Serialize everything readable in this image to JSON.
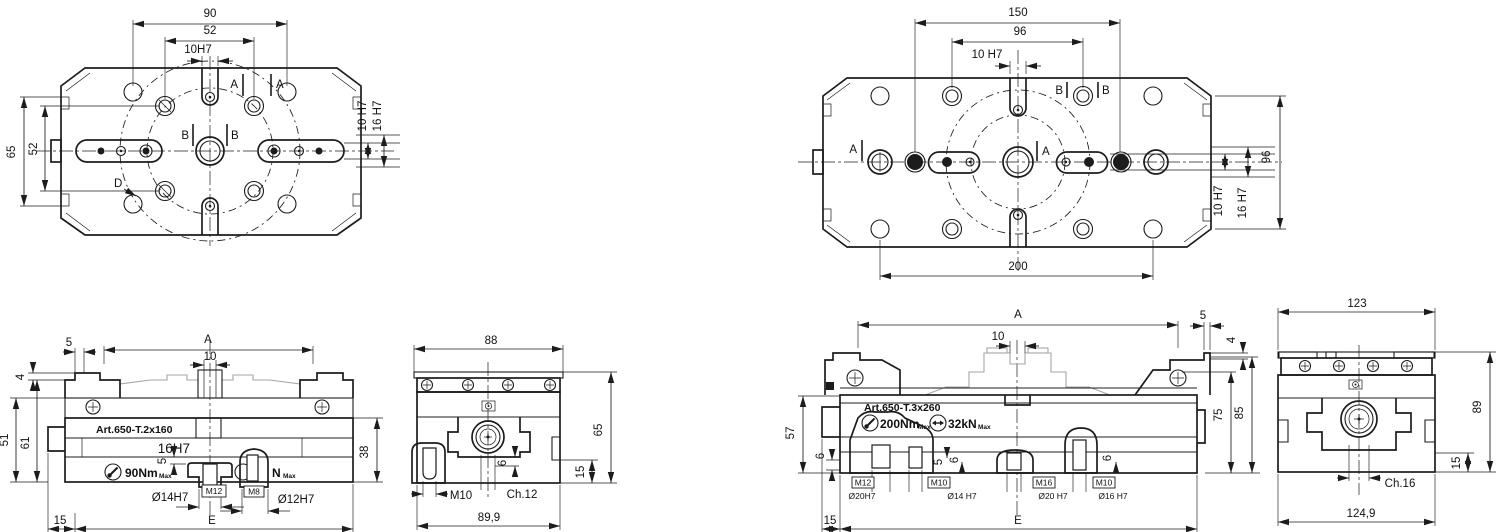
{
  "meta": {
    "type": "technical-drawing",
    "colors": {
      "line": "#1c1c1c",
      "light_gray": "#a6a6a6"
    }
  },
  "v1": {
    "dim_90": "90",
    "dim_52_top": "52",
    "dim_10h7_top": "10H7",
    "label_a1": "A",
    "label_a2": "A",
    "label_b1": "B",
    "label_b2": "B",
    "label_d": "D",
    "dim_65": "65",
    "dim_52_left": "52",
    "dim_10h7_side": "10 H7",
    "dim_16h7_side": "16 H7"
  },
  "v2": {
    "dim_150": "150",
    "dim_96_top": "96",
    "dim_10h7_top": "10 H7",
    "label_b1": "B",
    "label_b2": "B",
    "label_a1": "A",
    "label_a2": "A",
    "dim_200": "200",
    "dim_96_side": "96",
    "dim_10h7_side": "10 H7",
    "dim_16h7_side": "16 H7"
  },
  "v3": {
    "dim_5": "5",
    "dim_4": "4",
    "dim_a": "A",
    "dim_10": "10",
    "dim_51": "51",
    "dim_61": "61",
    "art": "Art.650-T.2x160",
    "slot": "16H7",
    "torque": "90Nm",
    "torque_max": "Max",
    "partial_n": "N",
    "partial_max": "Max",
    "dim_5b": "5",
    "m12": "M12",
    "d14": "Ø14H7",
    "m8": "M8",
    "d12": "Ø12H7",
    "dim_38": "38",
    "dim_15": "15",
    "dim_e": "E"
  },
  "v4": {
    "dim_88": "88",
    "dim_65": "65",
    "dim_15": "15",
    "dim_6": "6",
    "m10": "M10",
    "ch12": "Ch.12",
    "dim_899": "89,9"
  },
  "v5": {
    "dim_a": "A",
    "dim_10": "10",
    "dim_5": "5",
    "dim_4": "4",
    "dim_57": "57",
    "dim_6a": "6",
    "art": "Art.650-T.3x260",
    "torque": "200Nm",
    "torque_max": "Max",
    "force": "32kN",
    "force_max": "Max",
    "m12": "M12",
    "d20": "Ø20H7",
    "m10a": "M10",
    "d14": "Ø14 H7",
    "dim_5b": "5",
    "dim_6b": "6",
    "m16": "M16",
    "d20b": "Ø20 H7",
    "m10b": "M10",
    "d16": "Ø16 H7",
    "dim_6c": "6",
    "dim_75": "75",
    "dim_85": "85",
    "dim_15": "15",
    "dim_e": "E"
  },
  "v6": {
    "dim_123": "123",
    "dim_89": "89",
    "dim_15": "15",
    "ch16": "Ch.16",
    "dim_1249": "124,9"
  }
}
